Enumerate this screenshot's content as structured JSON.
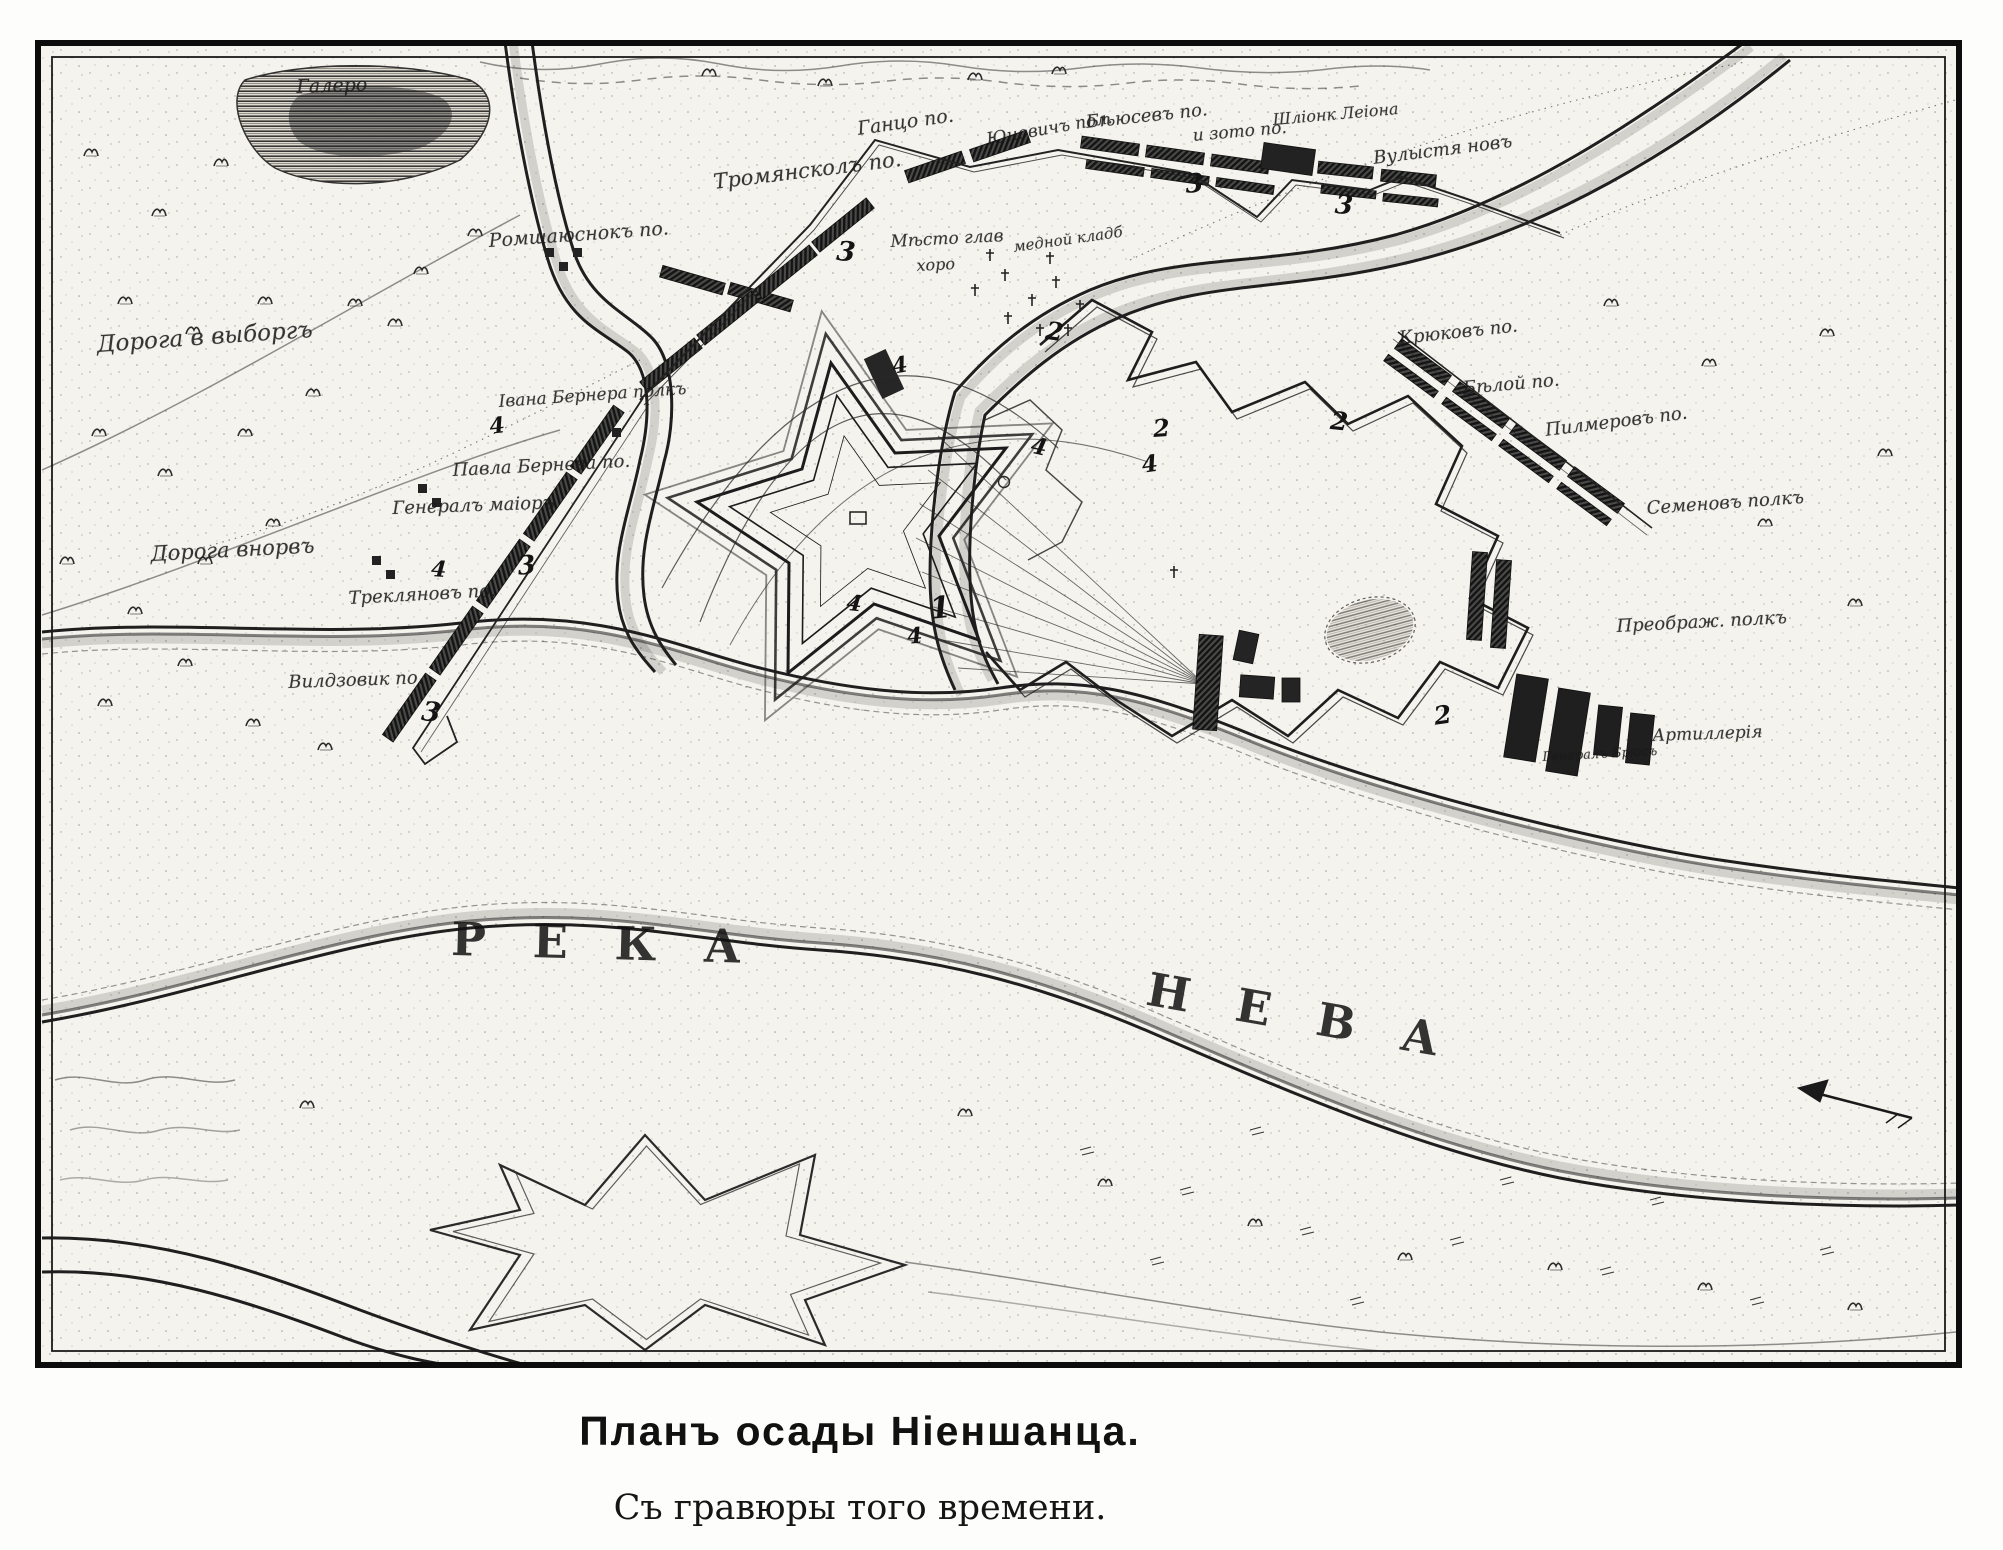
{
  "figure": {
    "caption_line1": "Планъ осады Ніеншанца.",
    "caption_line2": "Съ гравюры того времени."
  },
  "map": {
    "river_names": {
      "reka": "РЕКА",
      "neva": "НЕВА"
    },
    "labels": [
      {
        "name": "road-to-vyborg",
        "text": "Дорога в выборгъ"
      },
      {
        "name": "road-to-norv",
        "text": "Дорога внорвъ"
      },
      {
        "name": "lake-name",
        "text": "Галеро"
      },
      {
        "name": "regiment-romshayusnok",
        "text": "Ромшаюснокъ по."
      },
      {
        "name": "regiment-tromyanskol",
        "text": "Тромянсколъ по."
      },
      {
        "name": "regiment-gantso",
        "text": "Ганцо по."
      },
      {
        "name": "regiment-yunovich",
        "text": "Юновичъ пол."
      },
      {
        "name": "regiment-byusev",
        "text": "Бѣюсевъ по."
      },
      {
        "name": "regiment-izoto",
        "text": "и зото по."
      },
      {
        "name": "regiment-shlionk",
        "text": "Шліонк Леіона"
      },
      {
        "name": "regiment-vulysta",
        "text": "Вулыстя новъ"
      },
      {
        "name": "site-mesto-glav",
        "text": "Мѣсто глав"
      },
      {
        "name": "site-khoro",
        "text": "хоро"
      },
      {
        "name": "site-mednoy-klad",
        "text": "медной кладб"
      },
      {
        "name": "regiment-kryukov",
        "text": "Крюковъ по."
      },
      {
        "name": "regiment-bely",
        "text": "Бѣлой по."
      },
      {
        "name": "regiment-pilmerov",
        "text": "Пилмеровъ по."
      },
      {
        "name": "regiment-semyonov",
        "text": "Семеновъ полкъ"
      },
      {
        "name": "regiment-preobrazhensky",
        "text": "Преображ. полкъ"
      },
      {
        "name": "artillery",
        "text": "Артиллерія"
      },
      {
        "name": "general-bryus",
        "text": "Генералъ Брюсъ"
      },
      {
        "name": "regiment-ivana-bernera",
        "text": "Івана Бернера полкъ"
      },
      {
        "name": "regiment-pavla-berneva",
        "text": "Павла Бернева по."
      },
      {
        "name": "general-major",
        "text": "Генералъ маіоръ"
      },
      {
        "name": "regiment-treklyanov",
        "text": "Трекляновъ по."
      },
      {
        "name": "regiment-vildzovik",
        "text": "Вилдзовик по."
      }
    ],
    "numerals": [
      "1",
      "2",
      "2",
      "2",
      "2",
      "3",
      "3",
      "3",
      "3",
      "3",
      "4",
      "4",
      "4",
      "4",
      "4",
      "4",
      "4"
    ],
    "colors": {
      "ink": "#1b1b1b",
      "paper": "#f5f3ed"
    }
  }
}
